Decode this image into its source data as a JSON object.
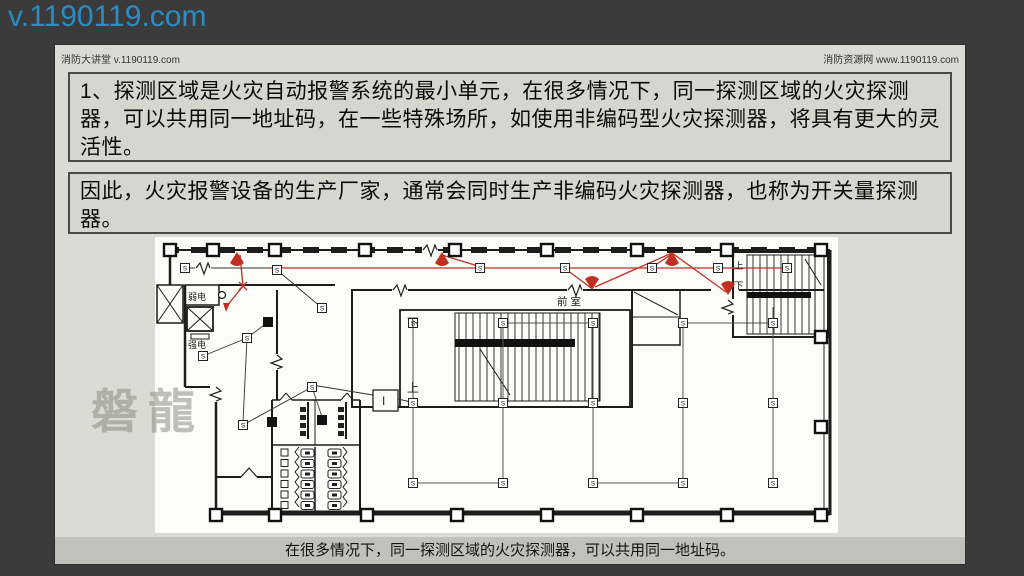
{
  "overlay": {
    "site": "v.1190119.com"
  },
  "header": {
    "left": "消防大讲堂 v.1190119.com",
    "right": "消防资源网 www.1190119.com"
  },
  "content": {
    "box1": "1、探测区域是火灾自动报警系统的最小单元，在很多情况下，同一探测区域的火灾探测器，可以共用同一地址码，在一些特殊场所，如使用非编码型火灾探测器，将具有更大的灵活性。",
    "box2": "因此，火灾报警设备的生产厂家，通常会同时生产非编码火灾探测器，也称为开关量探测器。",
    "caption": "在很多情况下，同一探测区域的火灾探测器，可以共用同一地址码。"
  },
  "floorplan": {
    "watermark": "磐龍",
    "labels": {
      "weak_power_room": "弱电",
      "strong_power_room": "强电",
      "front_room": "前室",
      "stair_up": "上",
      "stair_down": "下",
      "zone_marker": "I",
      "smoke_detector": "S"
    },
    "colors": {
      "wire_red": "#c03022",
      "ink": "#1d1d1d",
      "paper": "#fcfcf9"
    },
    "smoke_detectors": [
      [
        30,
        31
      ],
      [
        122,
        33
      ],
      [
        325,
        31
      ],
      [
        410,
        31
      ],
      [
        497,
        31
      ],
      [
        563,
        31
      ],
      [
        632,
        31
      ],
      [
        167,
        71
      ],
      [
        48,
        119
      ],
      [
        92,
        101
      ],
      [
        88,
        188
      ],
      [
        157,
        150
      ],
      [
        258,
        86
      ],
      [
        258,
        166
      ],
      [
        258,
        246
      ],
      [
        348,
        86
      ],
      [
        348,
        166
      ],
      [
        348,
        246
      ],
      [
        438,
        86
      ],
      [
        438,
        166
      ],
      [
        438,
        246
      ],
      [
        528,
        86
      ],
      [
        528,
        166
      ],
      [
        528,
        246
      ],
      [
        618,
        86
      ],
      [
        618,
        166
      ],
      [
        618,
        246
      ]
    ],
    "alarm_bells": [
      [
        82,
        15,
        0
      ],
      [
        287,
        15,
        0
      ],
      [
        517,
        15,
        0
      ],
      [
        437,
        53,
        180
      ],
      [
        573,
        58,
        180
      ]
    ],
    "columns_hollow": [
      [
        15,
        13
      ],
      [
        58,
        13
      ],
      [
        120,
        13
      ],
      [
        210,
        13
      ],
      [
        300,
        13
      ],
      [
        392,
        13
      ],
      [
        482,
        13
      ],
      [
        572,
        13
      ],
      [
        666,
        13
      ],
      [
        61,
        278
      ],
      [
        120,
        278
      ],
      [
        212,
        278
      ],
      [
        302,
        278
      ],
      [
        392,
        278
      ],
      [
        482,
        278
      ],
      [
        572,
        278
      ],
      [
        666,
        278
      ],
      [
        666,
        100
      ],
      [
        666,
        190
      ]
    ],
    "columns_filled": [
      [
        113,
        85
      ],
      [
        117,
        185
      ],
      [
        167,
        183
      ]
    ]
  }
}
